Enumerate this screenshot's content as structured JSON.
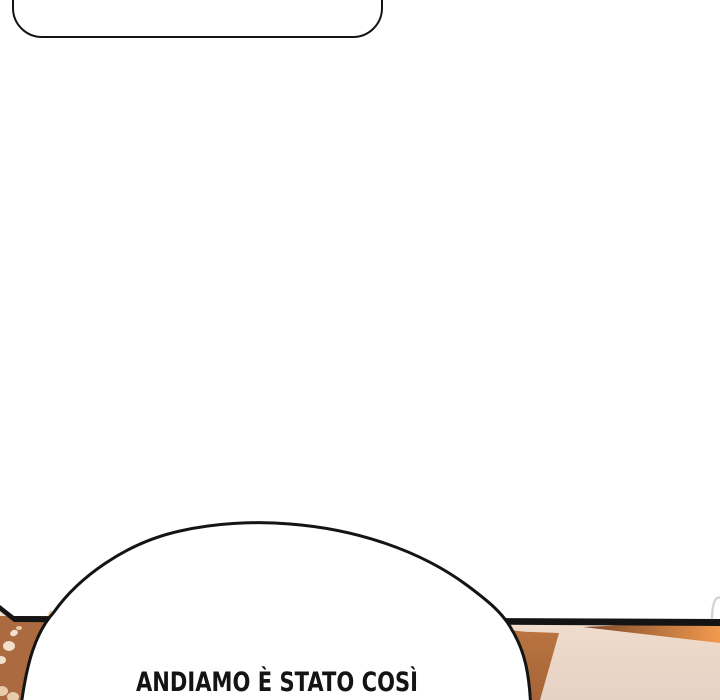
{
  "panel": {
    "dialogue": {
      "bottom_text": "ANDIAMO È STATO COSÌ"
    },
    "colors": {
      "ink": "#141414",
      "bubble_fill": "#ffffff",
      "beige_light": "#f1decd",
      "beige_dark": "#e6d1c4",
      "hair_brown": "#ab6a40",
      "hair_strip": "#eccaaa",
      "dot_light": "#f2e0ce",
      "dot_mid": "#e8cbab",
      "wedge_top": "#b9743f",
      "wedge_bottom": "#a66438",
      "band_dark": "#7e472a",
      "band_bright": "#f09a4e",
      "corner_gray": "#d8d4d1"
    }
  }
}
